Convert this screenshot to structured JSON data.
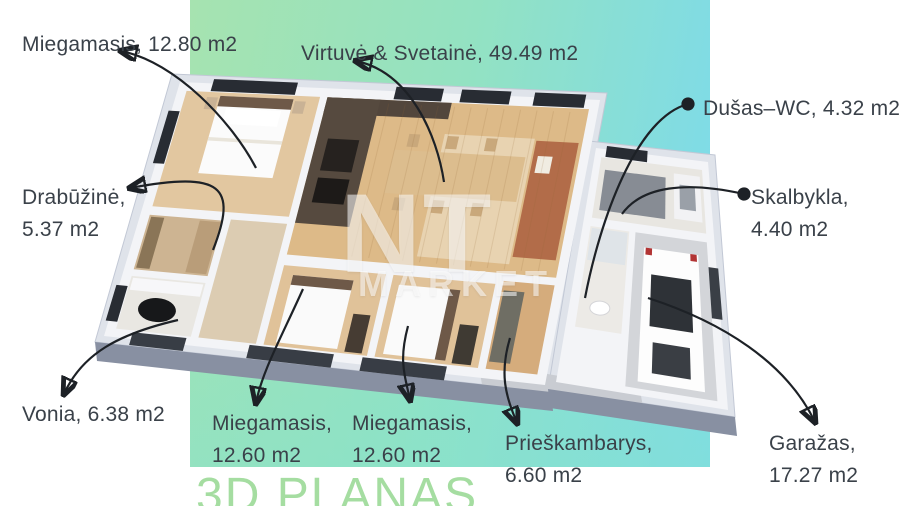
{
  "title": "3D PLANAS",
  "watermark": {
    "line1": "NT",
    "line2": "MARKET"
  },
  "colors": {
    "gradient-green": "#a6e3b0",
    "gradient-cyan": "#7bdaee",
    "gradient-teal": "#86e2cc",
    "title-green": "#a5dda1",
    "label-text": "#3a4149",
    "leader-line": "#1d2126",
    "watermark-white": "rgba(255,255,255,0.55)"
  },
  "labels": [
    {
      "id": "miegamasis-top",
      "line1": "Miegamasis, 12.80 m2"
    },
    {
      "id": "virtuve-svetaine",
      "line1": "Virtuvė & Svetainė, 49.49 m2"
    },
    {
      "id": "dusas-wc",
      "line1": "Dušas–WC, 4.32 m2"
    },
    {
      "id": "skalbykla",
      "line1": "Skalbykla,",
      "line2": "4.40 m2"
    },
    {
      "id": "drabuzine",
      "line1": "Drabūžinė,",
      "line2": "5.37 m2"
    },
    {
      "id": "vonia",
      "line1": "Vonia, 6.38 m2"
    },
    {
      "id": "miegamasis-b1",
      "line1": "Miegamasis,",
      "line2": "12.60 m2"
    },
    {
      "id": "miegamasis-b2",
      "line1": "Miegamasis,",
      "line2": "12.60 m2"
    },
    {
      "id": "prieskambarys",
      "line1": "Prieškambarys,",
      "line2": "6.60 m2"
    },
    {
      "id": "garazas",
      "line1": "Garažas,",
      "line2": "17.27 m2"
    }
  ]
}
